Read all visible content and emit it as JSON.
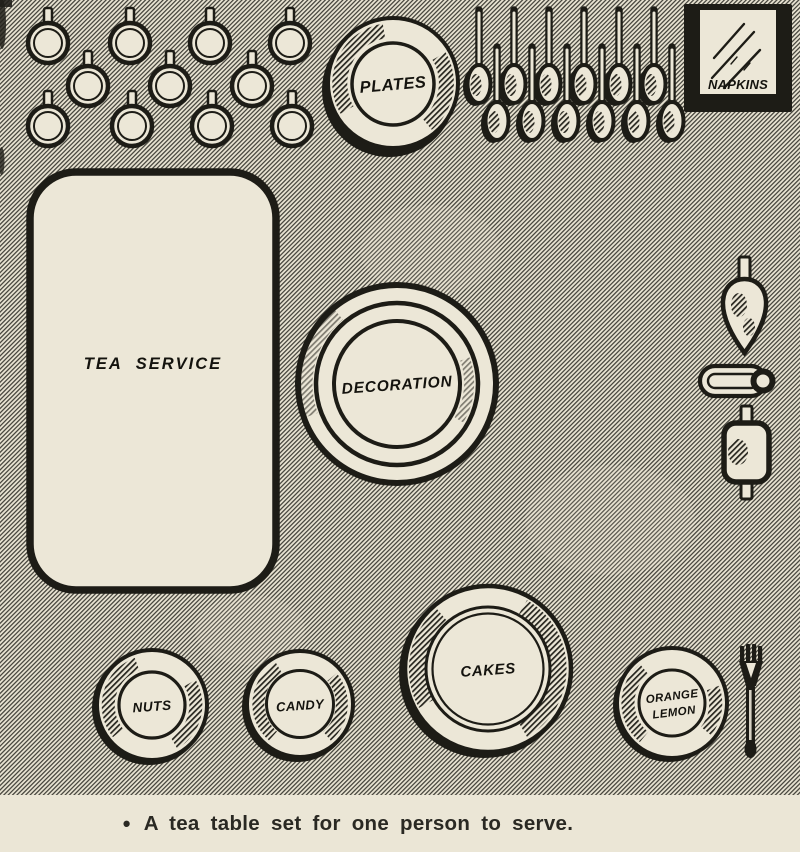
{
  "figure": {
    "type": "tea-table-setting-diagram",
    "items": {
      "plates_label": "PLATES",
      "napkins_label": "NAPKINS",
      "tea_service_label": "TEA SERVICE",
      "decoration_label": "DECORATION",
      "nuts_label": "NUTS",
      "candy_label": "CANDY",
      "cakes_label": "CAKES",
      "orange_label": "ORANGE",
      "lemon_label": "LEMON"
    },
    "unlabeled_items": {
      "cups_count": 11,
      "spoons_count": 12,
      "other_utensils": [
        "creamer",
        "sugar-tongs",
        "sugar-bowl",
        "fork"
      ]
    },
    "colors": {
      "paper": "#ebe6d6",
      "ink": "#1d1c16",
      "cream_fill": "#ece7d7",
      "hatch_base": "#e7e2d1",
      "hatch_line": "#45443c"
    }
  },
  "caption": {
    "bullet": "•",
    "text": "A tea table set for one person to serve."
  }
}
